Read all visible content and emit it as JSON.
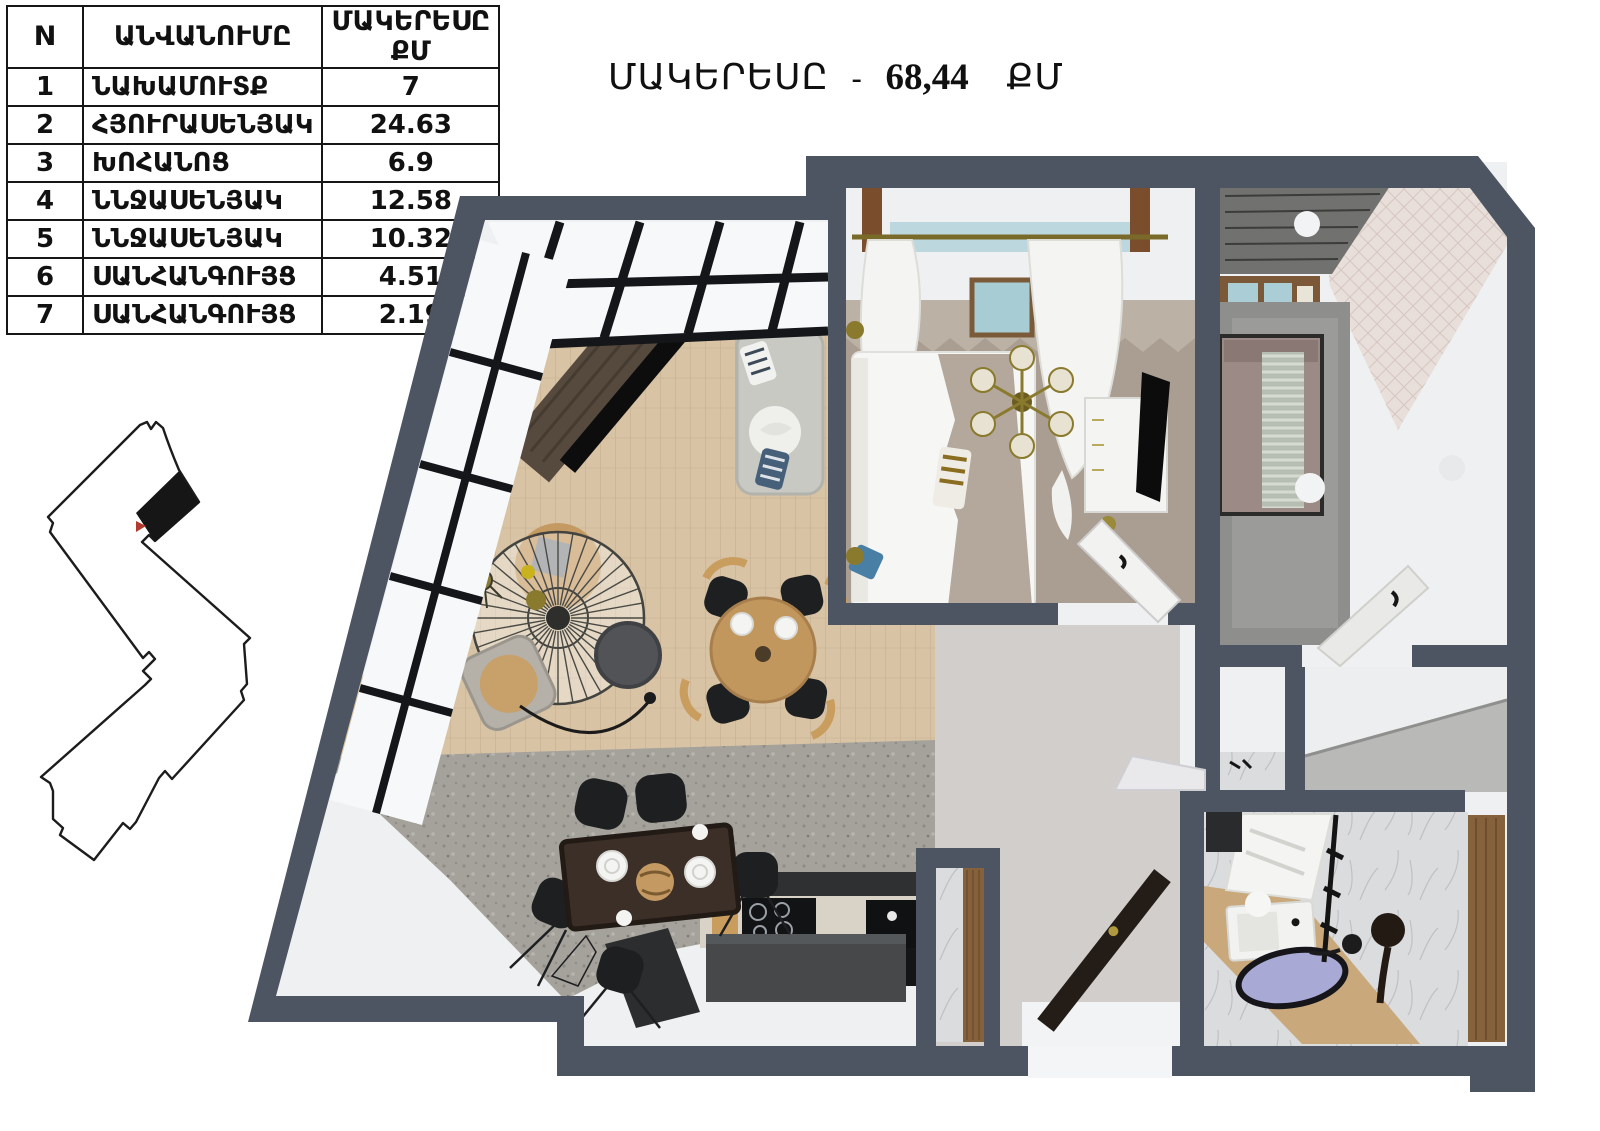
{
  "title": {
    "label": "ՄԱԿԵՐԵՍԸ",
    "separator": "-",
    "value": "68,44",
    "unit": "ՔՄ"
  },
  "table": {
    "headers": {
      "col_n": "N",
      "col_name": "ԱՆՎԱՆՈՒՄԸ",
      "col_area_line1": "ՄԱԿԵՐԵՍԸ",
      "col_area_line2": "ՔՄ"
    },
    "rows": [
      {
        "n": "1",
        "name": "ՆԱԽԱՄՈՒՏՔ",
        "area": "7"
      },
      {
        "n": "2",
        "name": "ՀՅՈՒՐԱՍԵՆՅԱԿ",
        "area": "24.63"
      },
      {
        "n": "3",
        "name": "ԽՈՀԱՆՈՑ",
        "area": "6.9"
      },
      {
        "n": "4",
        "name": "ՆՆՋԱՍԵՆՅԱԿ",
        "area": "12.58"
      },
      {
        "n": "5",
        "name": "ՆՆՋԱՍԵՆՅԱԿ",
        "area": "10.32"
      },
      {
        "n": "6",
        "name": "ՍԱՆՀԱՆԳՈՒՅՑ",
        "area": "4.51"
      },
      {
        "n": "7",
        "name": "ՍԱՆՀԱՆԳՈՒՅՑ",
        "area": "2.19"
      }
    ]
  },
  "total_area_sqm": "68,44",
  "colors": {
    "wall": "#4d5563",
    "floor_white": "#eef0f1",
    "parquet": "#d8c3a5",
    "terrazzo": "#a5a29c",
    "taupe_carpet": "#aa9d91",
    "gray_carpet": "#8e8e8c",
    "marble": "#dbdcde",
    "wood_door": "#85613c",
    "counter_dark": "#2e3032",
    "table_tan": "#c49a62",
    "marker_red": "#b03a2e",
    "basin_lavender": "#a9a9d6"
  }
}
